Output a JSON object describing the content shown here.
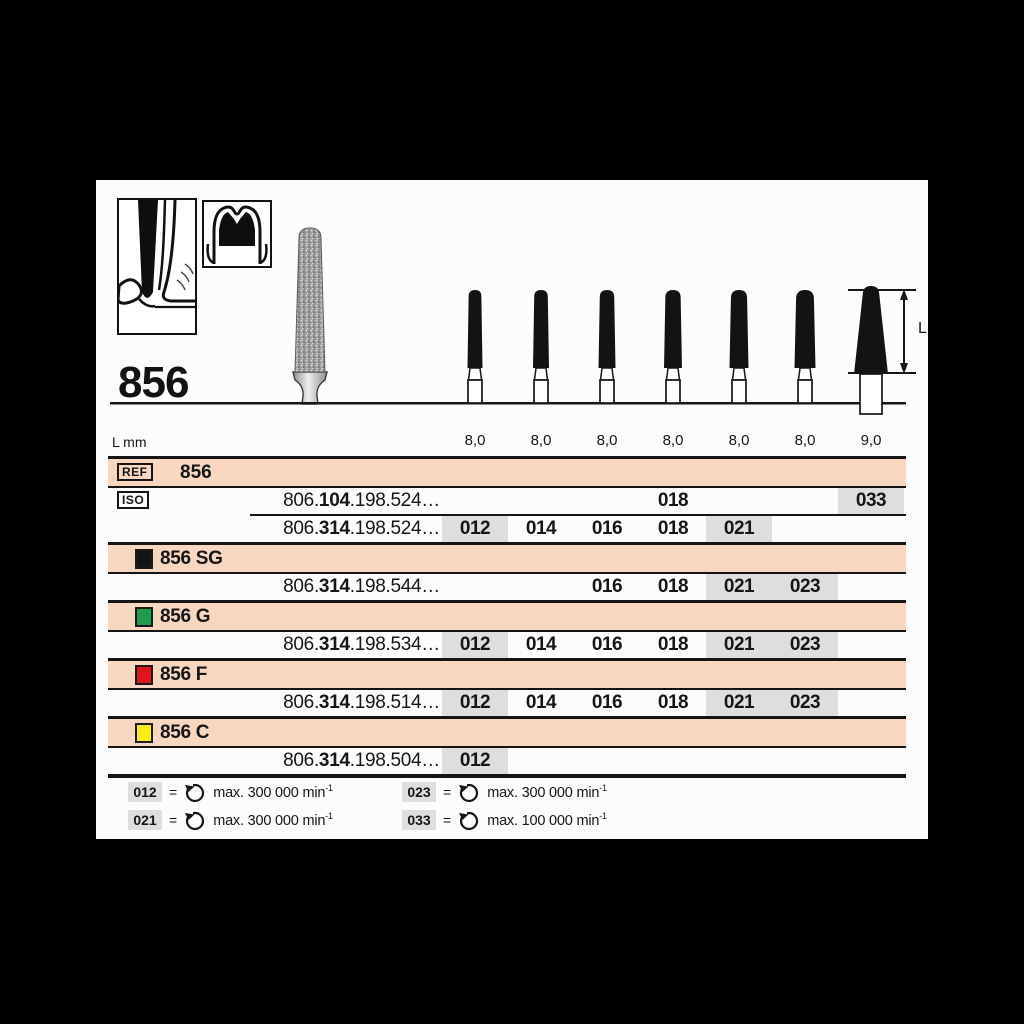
{
  "header": {
    "title": "856",
    "dimension_label": "L",
    "length_row_label": "L mm",
    "lengths": [
      "8,0",
      "8,0",
      "8,0",
      "8,0",
      "8,0",
      "8,0",
      "9,0"
    ]
  },
  "table": {
    "ref": {
      "label": "REF",
      "value": "856"
    },
    "iso_label": "ISO",
    "rows": [
      {
        "code_pre": "806.",
        "code_bold": "104",
        "code_post": ".198.524…",
        "cells": [
          {
            "col": 4,
            "value": "018",
            "hl": false
          },
          {
            "col": 7,
            "value": "033",
            "hl": true
          }
        ]
      },
      {
        "code_pre": "806.",
        "code_bold": "314",
        "code_post": ".198.524…",
        "cells": [
          {
            "col": 1,
            "value": "012",
            "hl": true
          },
          {
            "col": 2,
            "value": "014",
            "hl": false
          },
          {
            "col": 3,
            "value": "016",
            "hl": false
          },
          {
            "col": 4,
            "value": "018",
            "hl": false
          },
          {
            "col": 5,
            "value": "021",
            "hl": true
          }
        ]
      }
    ],
    "variants": [
      {
        "name": "856 SG",
        "color": "#141414",
        "code_pre": "806.",
        "code_bold": "314",
        "code_post": ".198.544…",
        "cells": [
          {
            "col": 3,
            "value": "016",
            "hl": false
          },
          {
            "col": 4,
            "value": "018",
            "hl": false
          },
          {
            "col": 5,
            "value": "021",
            "hl": true
          },
          {
            "col": 6,
            "value": "023",
            "hl": true
          }
        ]
      },
      {
        "name": "856 G",
        "color": "#1d9b4e",
        "code_pre": "806.",
        "code_bold": "314",
        "code_post": ".198.534…",
        "cells": [
          {
            "col": 1,
            "value": "012",
            "hl": true
          },
          {
            "col": 2,
            "value": "014",
            "hl": false
          },
          {
            "col": 3,
            "value": "016",
            "hl": false
          },
          {
            "col": 4,
            "value": "018",
            "hl": false
          },
          {
            "col": 5,
            "value": "021",
            "hl": true
          },
          {
            "col": 6,
            "value": "023",
            "hl": true
          }
        ]
      },
      {
        "name": "856 F",
        "color": "#e0161d",
        "code_pre": "806.",
        "code_bold": "314",
        "code_post": ".198.514…",
        "cells": [
          {
            "col": 1,
            "value": "012",
            "hl": true
          },
          {
            "col": 2,
            "value": "014",
            "hl": false
          },
          {
            "col": 3,
            "value": "016",
            "hl": false
          },
          {
            "col": 4,
            "value": "018",
            "hl": false
          },
          {
            "col": 5,
            "value": "021",
            "hl": true
          },
          {
            "col": 6,
            "value": "023",
            "hl": true
          }
        ]
      },
      {
        "name": "856 C",
        "color": "#f6ec16",
        "code_pre": "806.",
        "code_bold": "314",
        "code_post": ".198.504…",
        "cells": [
          {
            "col": 1,
            "value": "012",
            "hl": true
          }
        ]
      }
    ]
  },
  "legend": {
    "items": [
      {
        "code": "012",
        "eq": "=",
        "text": "max. 300 000 min",
        "sup": "-1"
      },
      {
        "code": "023",
        "eq": "=",
        "text": "max. 300 000 min",
        "sup": "-1"
      },
      {
        "code": "021",
        "eq": "=",
        "text": "max. 300 000 min",
        "sup": "-1"
      },
      {
        "code": "033",
        "eq": "=",
        "text": "max. 100 000 min",
        "sup": "-1"
      }
    ]
  },
  "colors": {
    "band": "#f7d7c0",
    "highlight": "#dedede",
    "ink": "#161616"
  }
}
